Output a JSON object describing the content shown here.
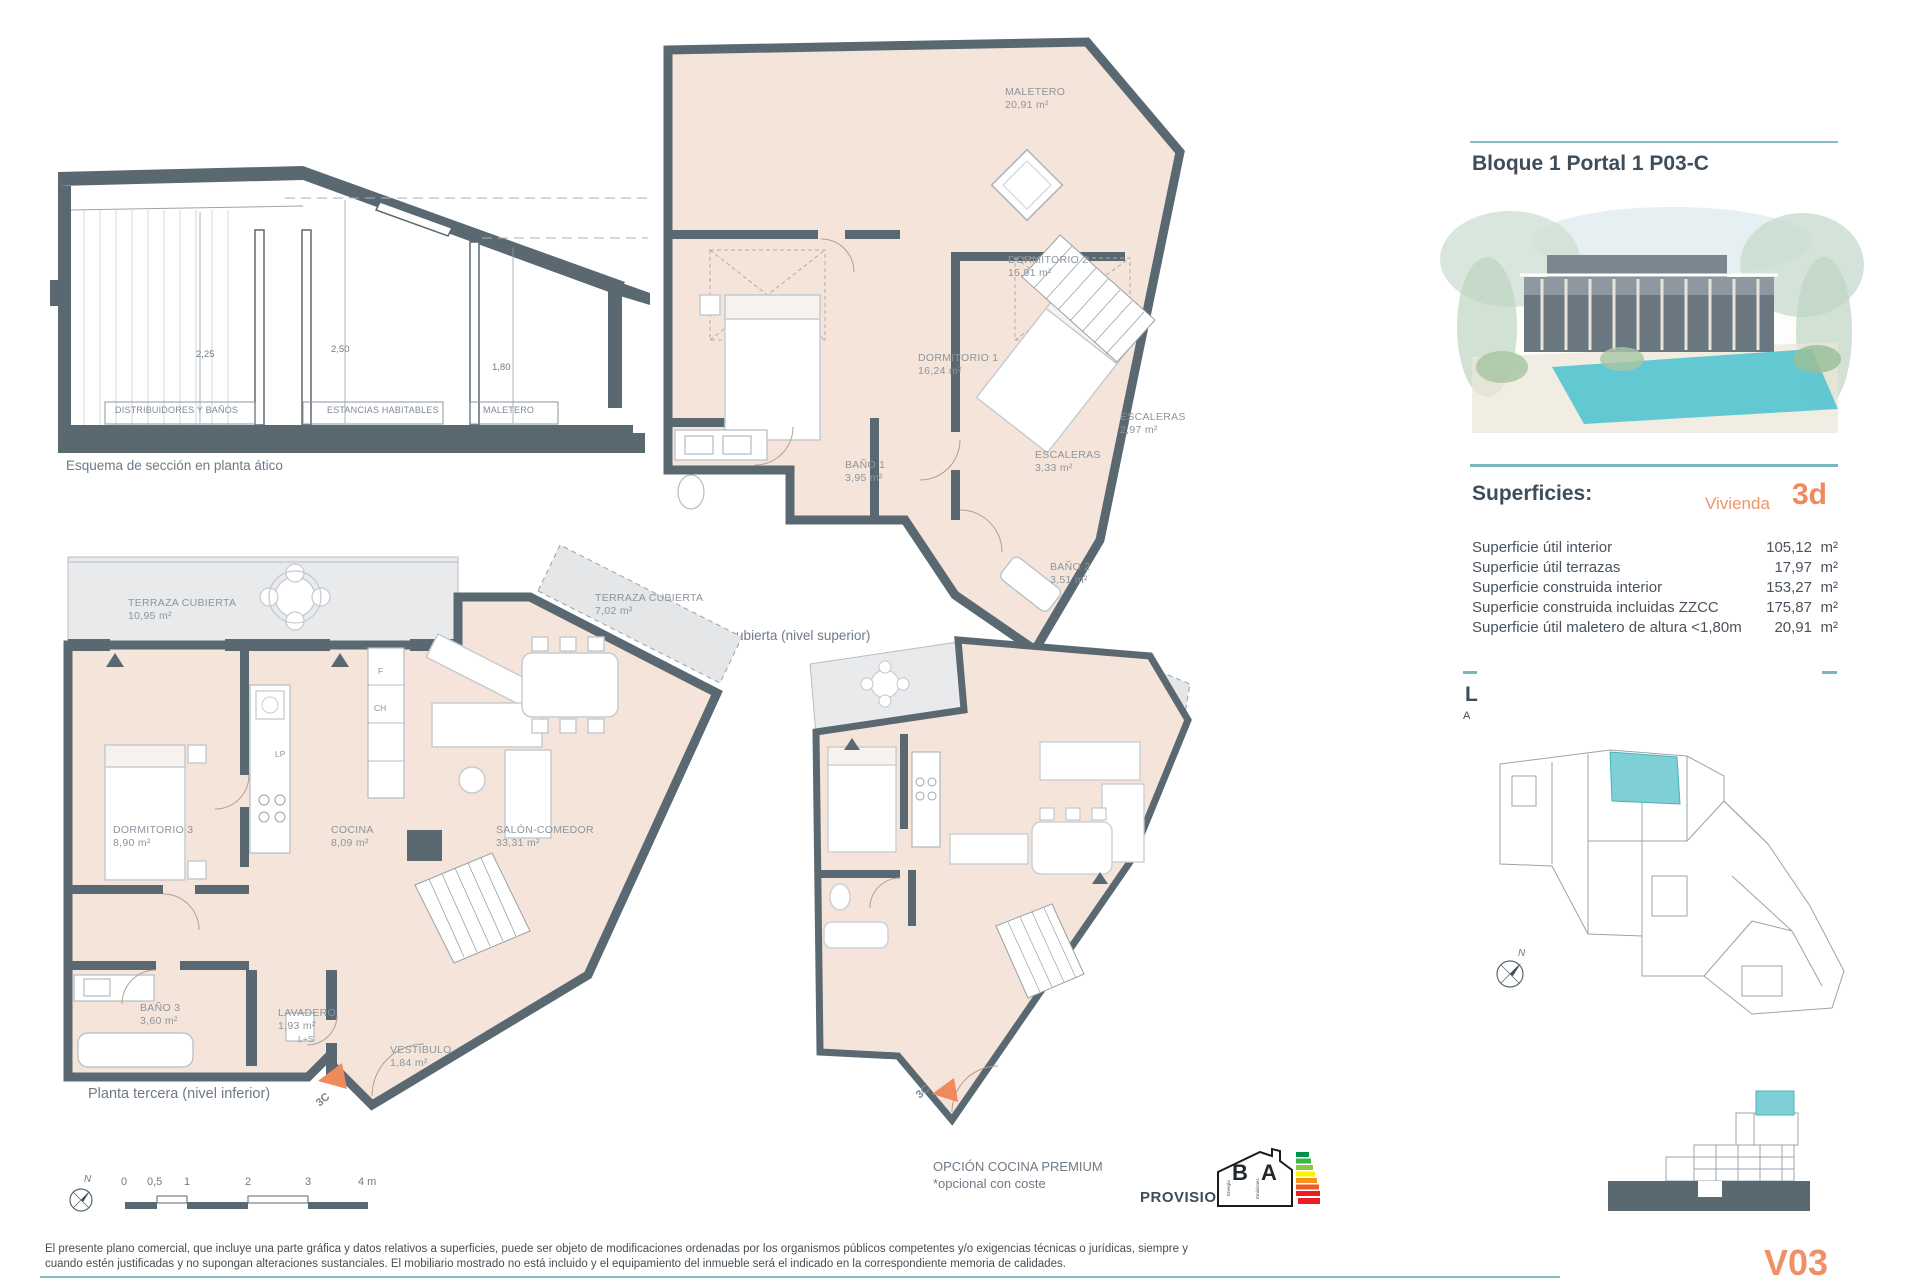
{
  "header": {
    "title": "Bloque 1 Portal 1 P03-C"
  },
  "section": {
    "caption": "Esquema de sección en planta ático",
    "dim_left": "2,25",
    "dim_mid": "2,50",
    "dim_right": "1,80",
    "zone_left": "DISTRIBUIDORES Y BAÑOS",
    "zone_mid": "ESTANCIAS HABITABLES",
    "zone_right": "MALETERO"
  },
  "upper_plan": {
    "caption": "Planta bajo cubierta (nivel superior)",
    "maletero_name": "MALETERO",
    "maletero_area": "20,91 m²",
    "dorm2_name": "DORMITORIO 2",
    "dorm2_area": "15,91 m²",
    "dorm1_name": "DORMITORIO 1",
    "dorm1_area": "16,24 m²",
    "bano1_name": "BAÑO 1",
    "bano1_area": "3,95 m²",
    "esc1_name": "ESCALERAS",
    "esc1_area": "3,33 m²",
    "esc2_name": "ESCALERAS",
    "esc2_area": "2,97 m²",
    "bano2_name": "BAÑO 2",
    "bano2_area": "3,51 m²"
  },
  "lower_plan": {
    "caption": "Planta tercera (nivel inferior)",
    "terraza1_name": "TERRAZA CUBIERTA",
    "terraza1_area": "10,95 m²",
    "dorm3_name": "DORMITORIO 3",
    "dorm3_area": "8,90 m²",
    "cocina_name": "COCINA",
    "cocina_area": "8,09 m²",
    "salon_name": "SALÓN-COMEDOR",
    "salon_area": "33,31 m²",
    "terraza2_name": "TERRAZA CUBIERTA",
    "terraza2_area": "7,02 m²",
    "bano3_name": "BAÑO 3",
    "bano3_area": "3,60 m²",
    "lavadero_name": "LAVADERO",
    "lavadero_area": "1,93 m²",
    "ls": "L+S",
    "vestibulo_name": "VESTÍBULO",
    "vestibulo_area": "1,84 m²",
    "f": "F",
    "ch": "CH",
    "lp": "LP",
    "unit_tag": "3C"
  },
  "premium_plan": {
    "title": "OPCIÓN COCINA PREMIUM",
    "note": "*opcional con coste",
    "unit_tag": "3C"
  },
  "sidebar": {
    "superficies_heading": "Superficies:",
    "vivienda_label": "Vivienda",
    "vivienda_code": "3d",
    "rows": [
      {
        "label": "Superficie útil interior",
        "value": "105,12",
        "unit": "m²"
      },
      {
        "label": "Superficie útil terrazas",
        "value": "17,97",
        "unit": "m²"
      },
      {
        "label": "Superficie construida interior",
        "value": "153,27",
        "unit": "m²"
      },
      {
        "label": "Superficie construida incluidas ZZCC",
        "value": "175,87",
        "unit": "m²"
      },
      {
        "label": "Superficie útil maletero de altura <1,80m",
        "value": "20,91",
        "unit": "m²"
      }
    ],
    "partial_l": "L",
    "partial_a": "A"
  },
  "energy": {
    "provisional": "PROVISIONAL",
    "letter_b": "B",
    "letter_a": "A",
    "side_b": "Energía",
    "side_a": "Emisiones"
  },
  "scalebar": {
    "north": "N",
    "t0": "0",
    "t05": "0,5",
    "t1": "1",
    "t2": "2",
    "t3": "3",
    "t4": "4 m"
  },
  "keyplan": {
    "north": "N"
  },
  "footer": {
    "line1": "El presente plano comercial, que incluye una parte gráfica y datos relativos a superficies, puede ser objeto de modificaciones ordenadas por los organismos públicos competentes y/o exigencias técnicas o jurídicas, siempre y",
    "line2": "cuando estén justificadas y no supongan alteraciones sustanciales. El mobiliario mostrado no está incluido y el equipamiento del inmueble será el indicado en la correspondiente memoria de calidades.",
    "version": "V03"
  }
}
